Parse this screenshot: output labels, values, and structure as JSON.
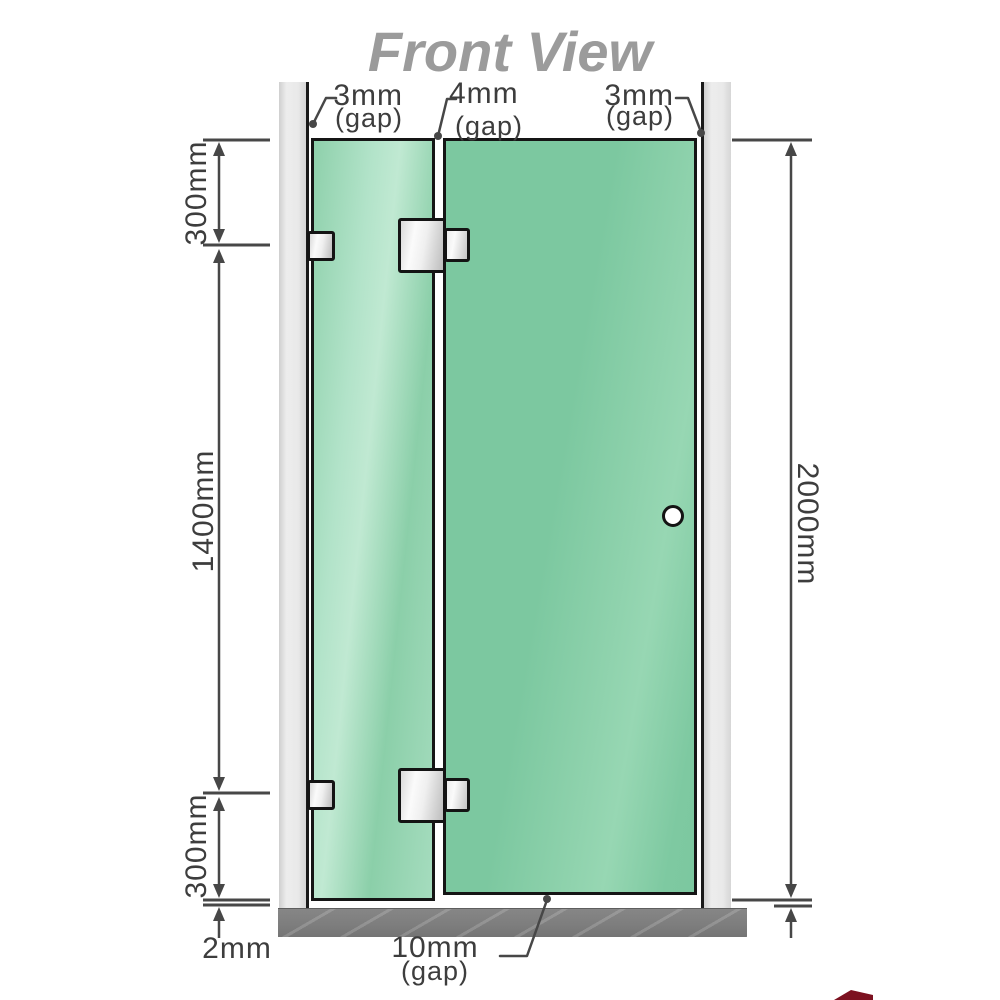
{
  "title": "Front View",
  "top_gap_labels": [
    {
      "value": "3mm",
      "suffix": "(gap)"
    },
    {
      "value": "4mm",
      "suffix": "(gap)"
    },
    {
      "value": "3mm",
      "suffix": "(gap)"
    }
  ],
  "left_dimensions": {
    "segment_top": "300mm",
    "segment_middle": "1400mm",
    "segment_bottom": "300mm",
    "floor_gap": "2mm"
  },
  "right_dimension": {
    "total_height": "2000mm"
  },
  "bottom_gap_label": {
    "value": "10mm",
    "suffix": "(gap)"
  },
  "colors": {
    "glass_green": "#7cc8a0",
    "glass_green_light": "#b2e3c9",
    "wall_gray": "#e9e9e9",
    "floor_gray": "#7d7d7d",
    "title_gray": "#9b9b9b",
    "dimension_line": "#474747",
    "label_text": "#3d3d3d",
    "logo_red": "#7c1120"
  }
}
